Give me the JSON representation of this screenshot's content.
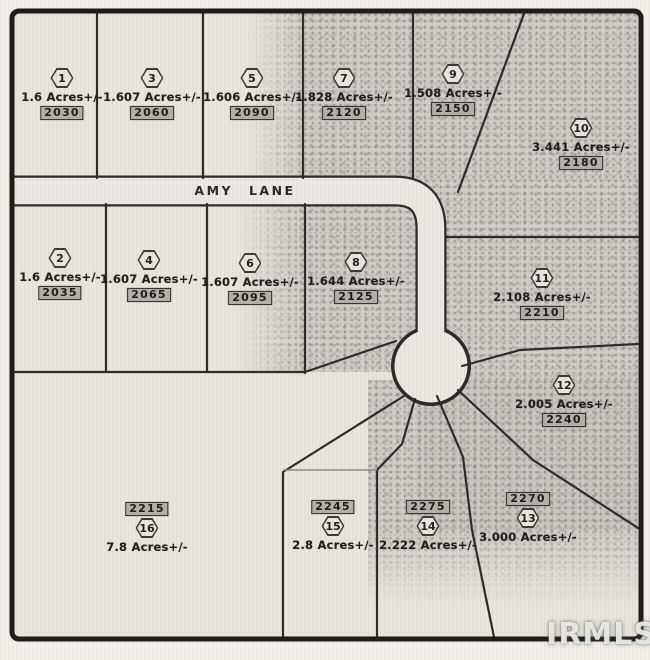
{
  "map": {
    "road_label": "AMY LANE",
    "watermark": "IRMLS"
  },
  "colors": {
    "paper": "#e8e5dd",
    "tree_texture": "#cbc9c2",
    "line": "#2c2b26",
    "road_fill": "#ebe8e1",
    "address_box_fill": "#b2b0a8"
  },
  "lots": [
    {
      "number": "1",
      "acres": "1.6 Acres+/-",
      "address": "2030"
    },
    {
      "number": "2",
      "acres": "1.6 Acres+/-",
      "address": "2035"
    },
    {
      "number": "3",
      "acres": "1.607 Acres+/-",
      "address": "2060"
    },
    {
      "number": "4",
      "acres": "1.607 Acres+/-",
      "address": "2065"
    },
    {
      "number": "5",
      "acres": "1.606 Acres+/-",
      "address": "2090"
    },
    {
      "number": "6",
      "acres": "1.607 Acres+/-",
      "address": "2095"
    },
    {
      "number": "7",
      "acres": "1.828 Acres+/-",
      "address": "2120"
    },
    {
      "number": "8",
      "acres": "1.644 Acres+/-",
      "address": "2125"
    },
    {
      "number": "9",
      "acres": "1.508 Acres+/-",
      "address": "2150"
    },
    {
      "number": "10",
      "acres": "3.441 Acres+/-",
      "address": "2180"
    },
    {
      "number": "11",
      "acres": "2.108 Acres+/-",
      "address": "2210"
    },
    {
      "number": "12",
      "acres": "2.005 Acres+/-",
      "address": "2240"
    },
    {
      "number": "13",
      "acres": "3.000 Acres+/-",
      "address": "2270"
    },
    {
      "number": "14",
      "acres": "2.222 Acres+/-",
      "address": "2275"
    },
    {
      "number": "15",
      "acres": "2.8 Acres+/-",
      "address": "2245"
    },
    {
      "number": "16",
      "acres": "7.8 Acres+/-",
      "address": "2215"
    }
  ]
}
